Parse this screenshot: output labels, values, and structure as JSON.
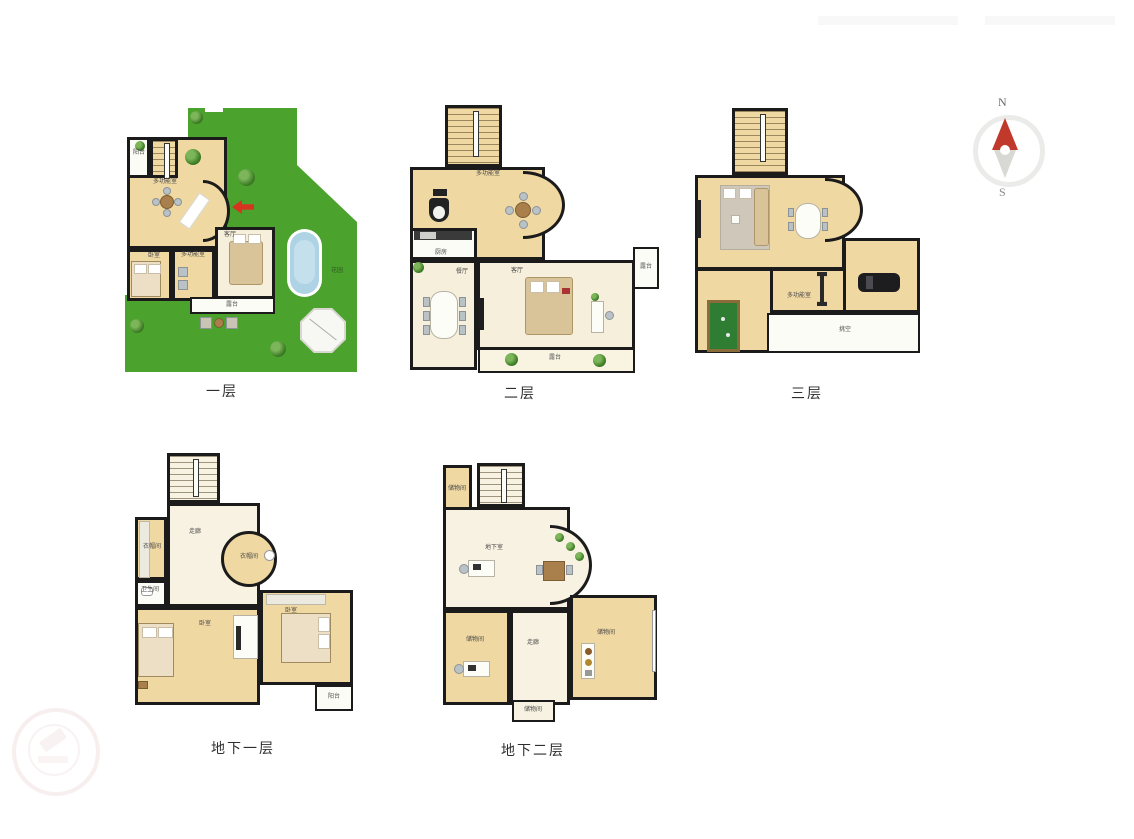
{
  "page": {
    "background": "#ffffff"
  },
  "compass": {
    "north": "N",
    "south": "S",
    "needle_up_color": "#c0392b",
    "needle_down_color": "#d8d8d4"
  },
  "palette": {
    "wall": "#1b1b1b",
    "wood_floor": "#f0d8a2",
    "light_floor": "#f6efdb",
    "white_floor": "#fcfcf6",
    "garden_green": "#4ba32e",
    "pool_blue": "#aed3e4",
    "billiard_green": "#2e7d32",
    "entry_arrow_red": "#d63420"
  },
  "floors": {
    "f1": {
      "caption": "一层",
      "rooms": {
        "balcony": "阳台",
        "hall": "多功能室",
        "multi": "多功能室",
        "bedroom": "卧室",
        "living": "客厅",
        "terrace": "露台",
        "garden": "花园"
      }
    },
    "f2": {
      "caption": "二层",
      "rooms": {
        "multi": "多功能室",
        "kitchen": "厨房",
        "dining": "餐厅",
        "living": "客厅",
        "bay": "露台",
        "terrace": "露台"
      }
    },
    "f3": {
      "caption": "三层",
      "rooms": {
        "multi": "多功能室",
        "void": "挑空"
      }
    },
    "b1": {
      "caption": "地下一层",
      "rooms": {
        "corridor": "走廊",
        "cloak_left": "衣帽间",
        "cloak_round": "衣帽间",
        "bath": "卫生间",
        "bed_main": "卧室",
        "bed_right": "卧室",
        "balcony": "阳台"
      }
    },
    "b2": {
      "caption": "地下二层",
      "rooms": {
        "store_top": "储物间",
        "basement": "地下室",
        "store_left": "储物间",
        "corridor": "走廊",
        "store_right": "储物间",
        "store_bottom": "储物间"
      }
    }
  }
}
